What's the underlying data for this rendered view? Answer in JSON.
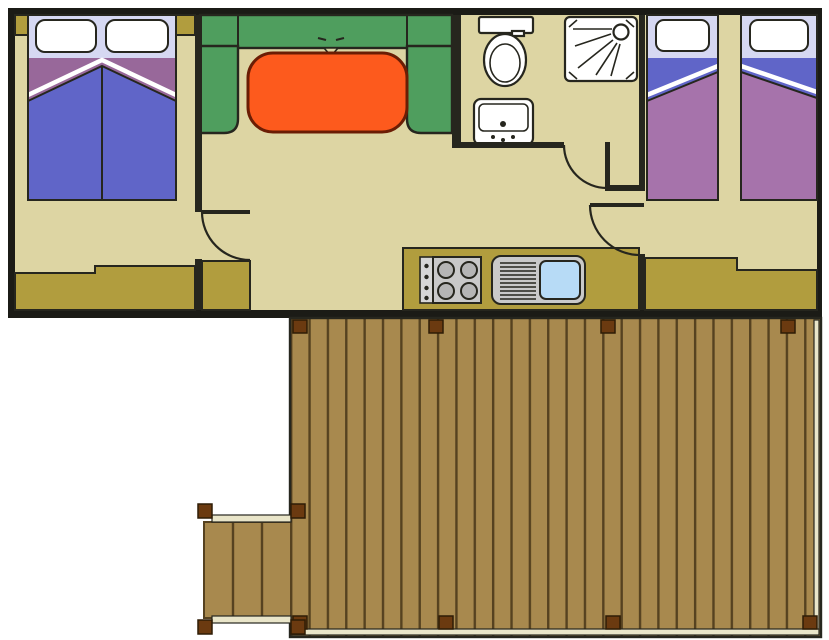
{
  "scene": {
    "type": "floor-plan",
    "subject": "holiday mobile-home floor plan with wooden terrace deck",
    "rooms": [
      {
        "name": "double-bedroom",
        "furniture": [
          "double-bed",
          "two-pillows",
          "wardrobe",
          "corner-posts"
        ]
      },
      {
        "name": "living-room",
        "furniture": [
          "u-shaped-sofa",
          "dining-table",
          "cabinet"
        ]
      },
      {
        "name": "bathroom",
        "furniture": [
          "toilet",
          "washbasin",
          "shower-cabin"
        ]
      },
      {
        "name": "kitchen",
        "furniture": [
          "hob-4-burners",
          "sink-with-drainboard",
          "counter"
        ]
      },
      {
        "name": "twin-bedroom",
        "furniture": [
          "twin-bed-left",
          "twin-bed-right",
          "wardrobe"
        ]
      },
      {
        "name": "terrace",
        "furniture": [
          "plank-deck",
          "entry-step-platform",
          "corner-bolts"
        ]
      }
    ],
    "door_count": 3,
    "bolt_rows": {
      "top": 4,
      "bottom": 4
    }
  },
  "colors": {
    "outline": "#26261e",
    "wall": "#26261e",
    "border": "#1b1b16",
    "floor": "#ddd5a3",
    "cabinet": "#b19d3e",
    "sofa": "#4f9e5e",
    "table": "#fd5a1d",
    "tableline": "#6b1d04",
    "bedblue": "#6065c8",
    "purpleband": "#98689a",
    "purpleduvet": "#a673ab",
    "headboard": "#d6d8f2",
    "white": "#ffffff",
    "gray1": "#c9c9c9",
    "gray2": "#b5b5b5",
    "basin": "#b7dbf6",
    "plank": "#a8894e",
    "plankline": "#564220",
    "trim": "#e9e5c9",
    "bolt": "#6b3a10",
    "boltline": "#2e1c06"
  }
}
